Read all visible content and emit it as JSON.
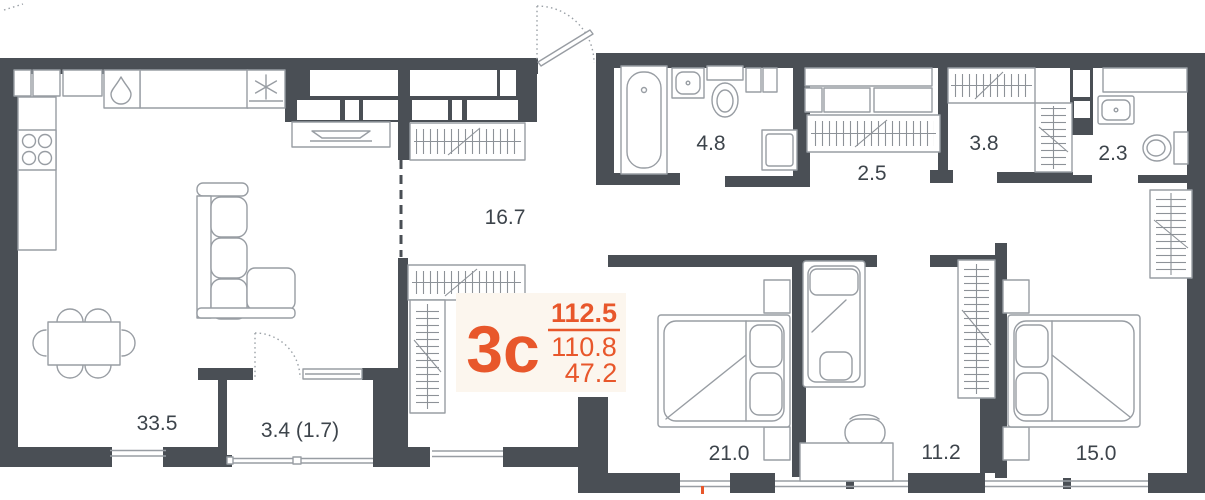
{
  "unit": {
    "type_label": "3с",
    "area_total": "112.5",
    "area_living": "110.8",
    "area_kitchen": "47.2"
  },
  "rooms": [
    {
      "name": "kitchen-living-room",
      "area": "33.5"
    },
    {
      "name": "loggia",
      "area": "3.4 (1.7)"
    },
    {
      "name": "hallway",
      "area": "16.7"
    },
    {
      "name": "bathroom",
      "area": "4.8"
    },
    {
      "name": "corridor",
      "area": "2.5"
    },
    {
      "name": "dressing-room",
      "area": "3.8"
    },
    {
      "name": "wc",
      "area": "2.3"
    },
    {
      "name": "bedroom-master",
      "area": "21.0"
    },
    {
      "name": "bedroom-small",
      "area": "11.2"
    },
    {
      "name": "bedroom-second",
      "area": "15.0"
    }
  ],
  "colors": {
    "wall": "#4a4f55",
    "furniture_line": "#989da3",
    "hatch_line": "#8d9298",
    "accent": "#e8572b",
    "room_label": "#3d444b",
    "card_bg": "#fcf6ee"
  }
}
